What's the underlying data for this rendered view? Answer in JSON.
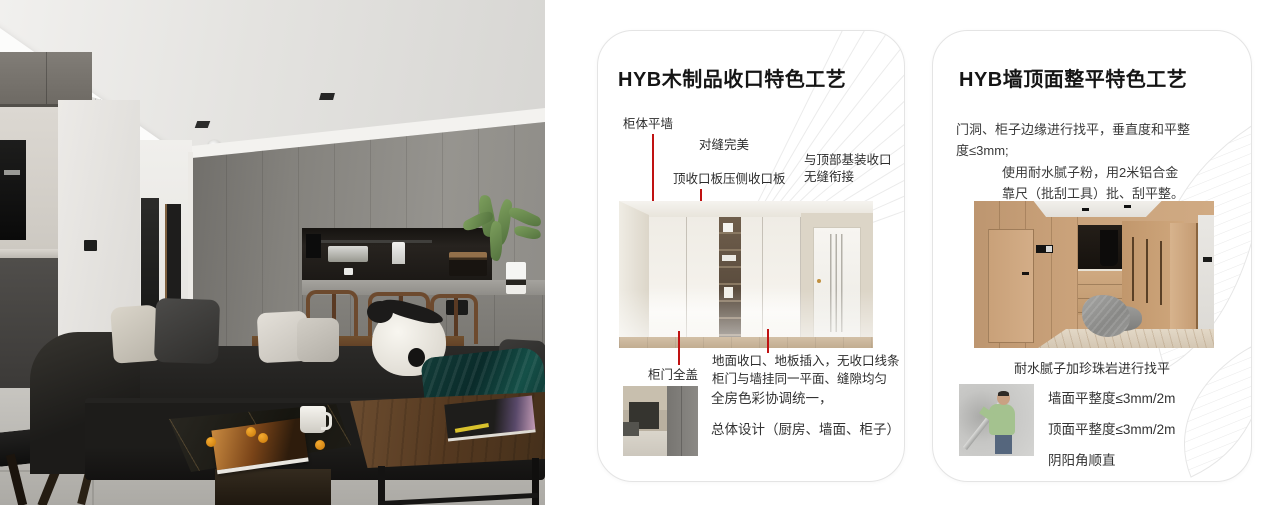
{
  "page": {
    "background": "#ffffff"
  },
  "colors": {
    "annotation_red": "#c01212",
    "card_border": "#e4e4e4",
    "pattern_line": "#ebebeb",
    "title_text": "#151515",
    "body_text": "#3a3a3a"
  },
  "cards": {
    "wood": {
      "title": "HYB木制品收口特色工艺",
      "labels": {
        "cabinet_flush": "柜体平墙",
        "perfect_seam": "对缝完美",
        "top_board": "顶收口板压侧收口板",
        "top_joint": [
          "与顶部基装收口",
          "无缝衔接"
        ],
        "full_cover": "柜门全盖",
        "floor_note": [
          "地面收口、地板插入，无收口线条",
          "柜门与墙挂同一平面、缝隙均匀"
        ]
      },
      "summary": [
        "全房色彩协调统一，",
        "总体设计（厨房、墙面、柜子）"
      ]
    },
    "wall": {
      "title": "HYB墙顶面整平特色工艺",
      "para1": [
        "门洞、柜子边缘进行找平，垂直度和平整",
        "度≤3mm;"
      ],
      "para2": [
        "使用耐水腻子粉，用2米铝合金",
        "靠尺（批刮工具）批、刮平整。"
      ],
      "caption": "耐水腻子加珍珠岩进行找平",
      "specs": [
        "墙面平整度≤3mm/2m",
        "顶面平整度≤3mm/2m",
        "阴阳角顺直"
      ]
    }
  }
}
